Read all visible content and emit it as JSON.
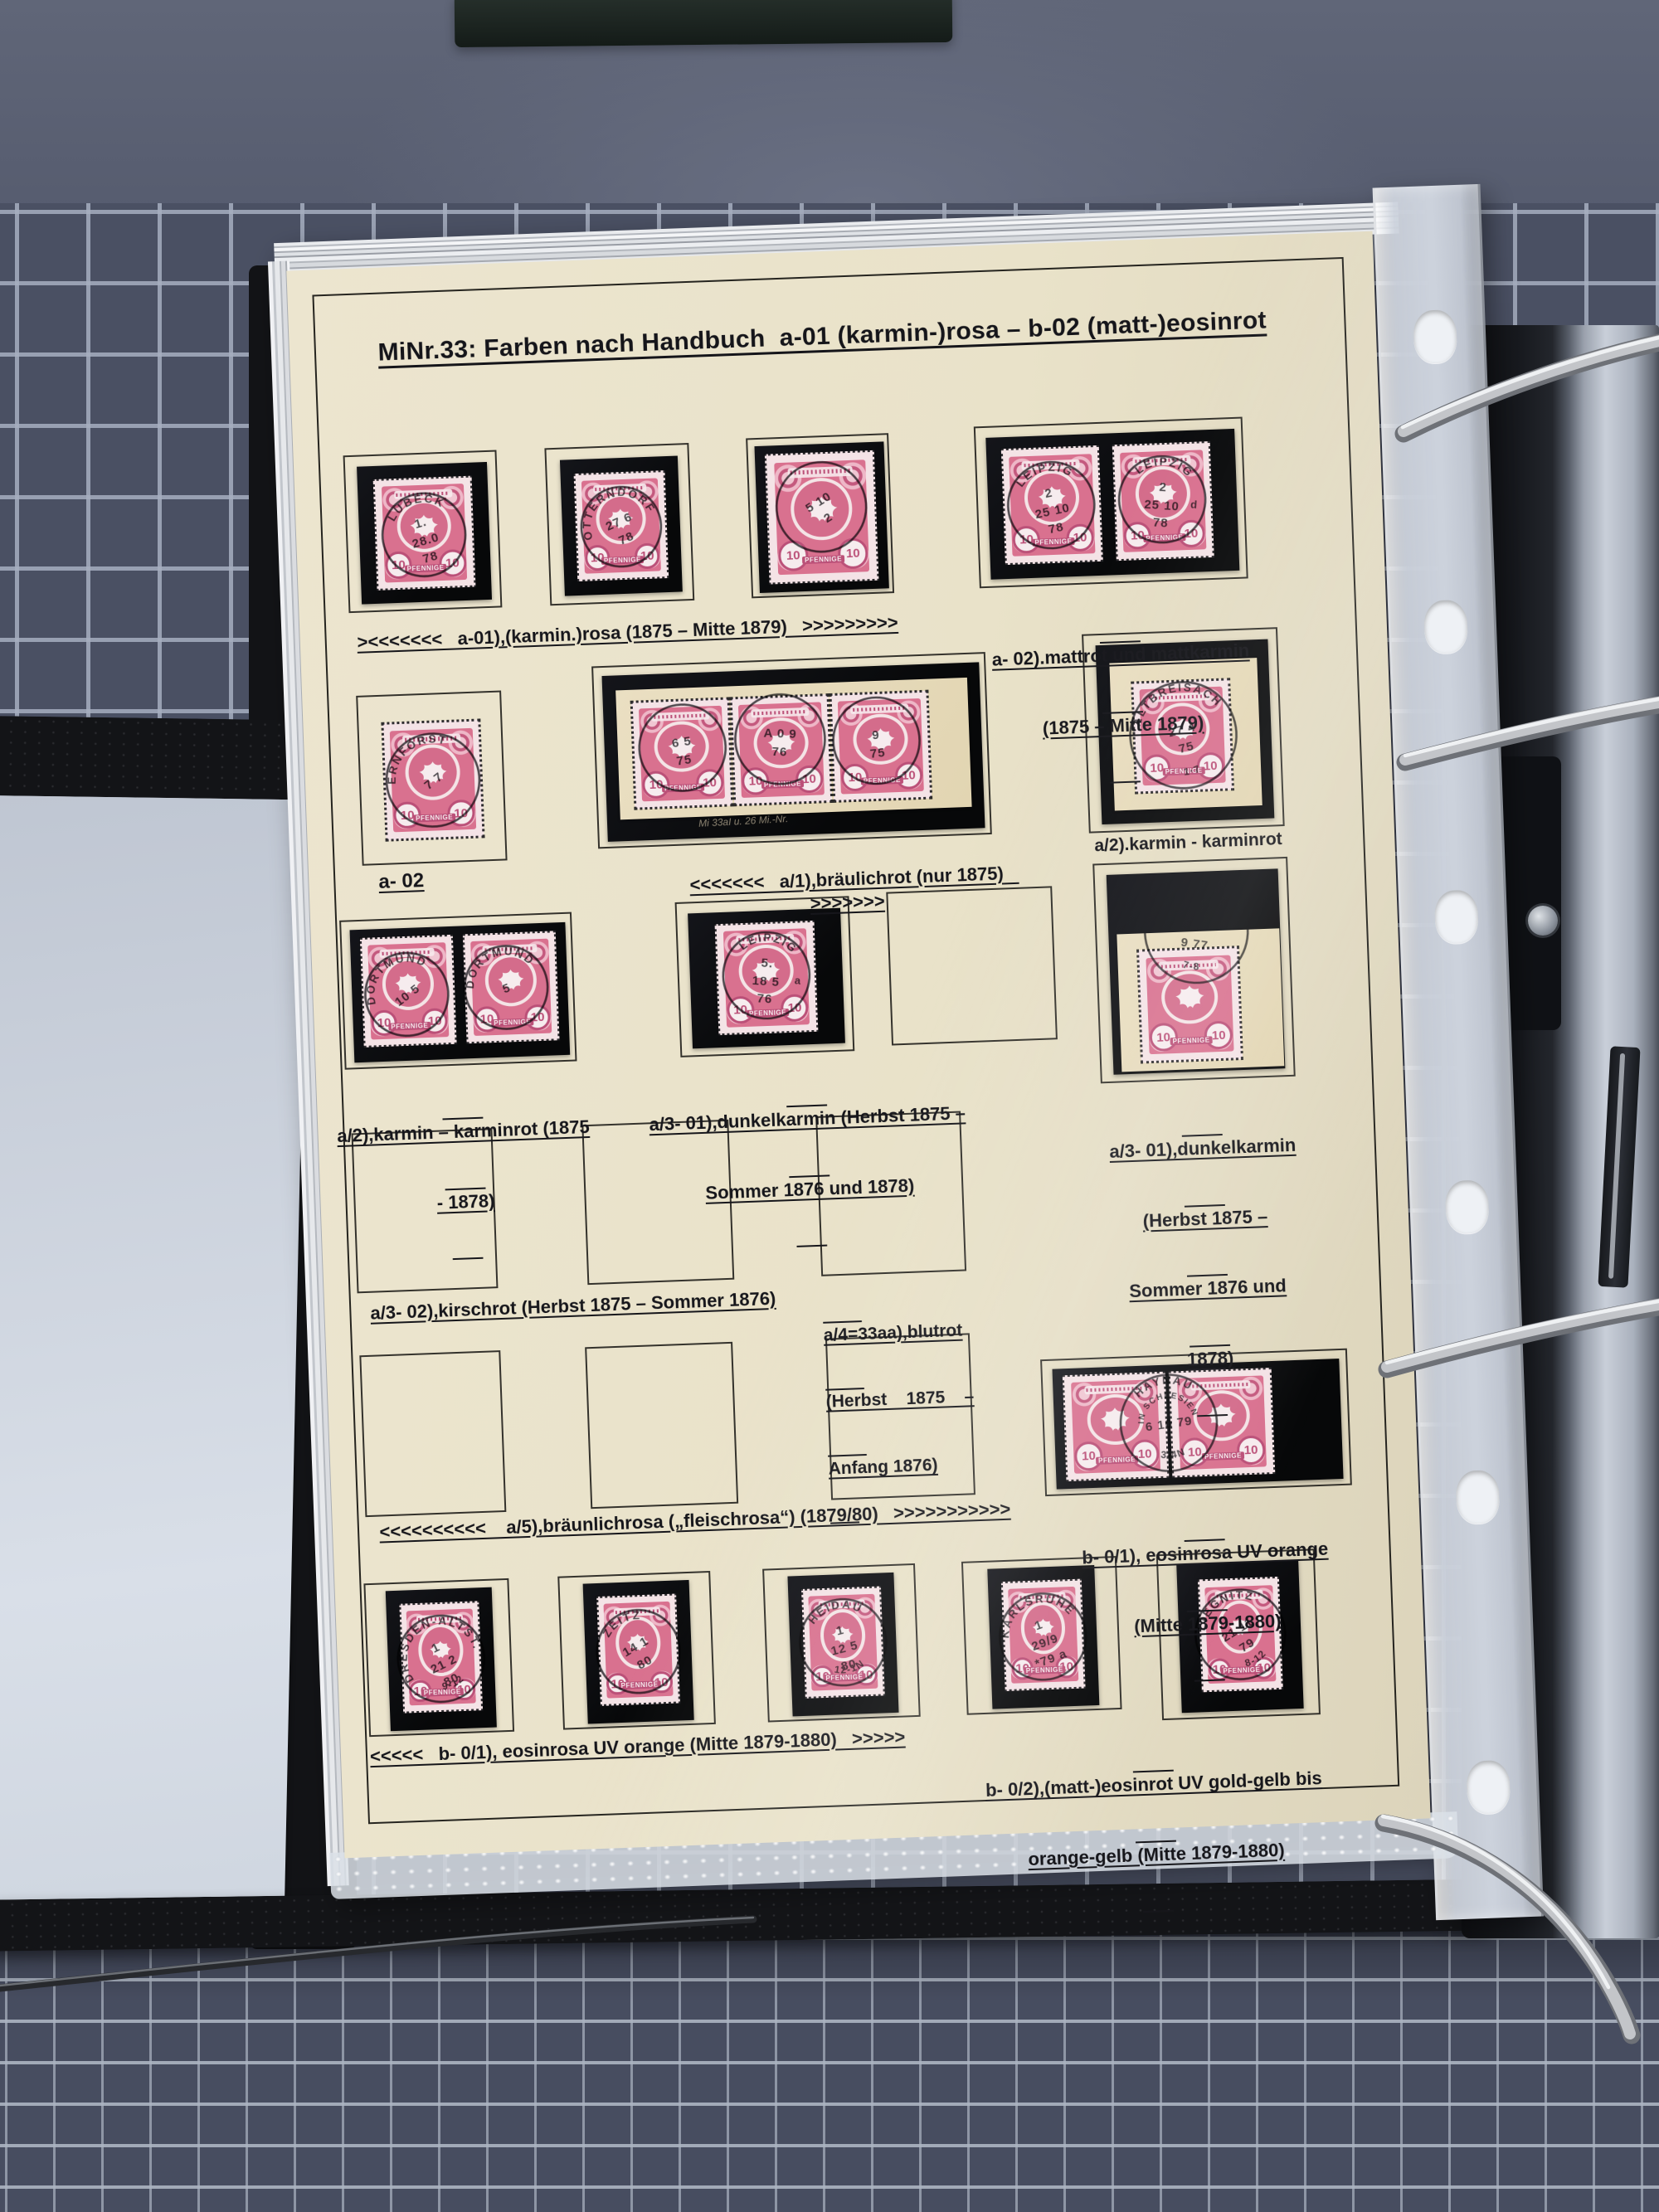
{
  "album": {
    "title": "MiNr.33: Farben nach Handbuch  a-01 (karmin-)rosa – b-02 (matt-)eosinrot",
    "captions": {
      "r1_left": "><<<<<<<   a-01),(karmin.)rosa (1875 – Mitte 1879)   >>>>>>>>>",
      "r1_right_l1": "a- 02).mattrot und mattkarmin",
      "r1_right_l2": "(1875 – Mitte 1879)",
      "r2_a02": "a- 02",
      "r2_strip": "<<<<<<<   a/1),bräulichrot (nur 1875)   >>>>>>>",
      "r2_right": "a/2).karmin - karminrot",
      "r3_pair_l1": "a/2),karmin – karminrot (1875",
      "r3_pair_l2": "- 1878)",
      "r3_mid_l1": "a/3- 01),dunkelkarmin (Herbst 1875 –",
      "r3_mid_l2": "Sommer 1876 und 1878)",
      "r3_right_l1": "a/3- 01),dunkelkarmin",
      "r3_right_l2": "(Herbst 1875 –",
      "r3_right_l3": "Sommer 1876 und",
      "r3_right_l4": "1878)",
      "r4_left": "a/3- 02),kirschrot (Herbst 1875 – Sommer 1876)",
      "r4_right_l1": "a/4=33aa),blutrot",
      "r4_right_l2": "(Herbst    1875    –",
      "r4_right_l3": "Anfang 1876)",
      "r5_left": "<<<<<<<<<<    a/5),bräunlichrosa („fleischrosa“) (1879/80)   >>>>>>>>>>>",
      "r5_right_l1": "b- 0/1), eosinrosa UV orange",
      "r5_right_l2": "(Mitte 1879-1880)",
      "r6_left": "<<<<<   b- 0/1), eosinrosa UV orange (Mitte 1879-1880)   >>>>>",
      "r6_right_l1": "b- 0/2),(matt-)eosinrot UV gold-gelb bis",
      "r6_right_l2": "orange-gelb (Mitte 1879-1880)"
    },
    "stamp_face": {
      "value": "10",
      "inscription": "PFENNIGE"
    },
    "strip_note": "Mi 33aI u. 26 Mi.-Nr.",
    "postmarks": {
      "lubeck": {
        "town": "LÜBECK",
        "lines": [
          "1.",
          "28.0",
          "78"
        ],
        "bottom": ""
      },
      "otterndorf": {
        "town": "OTTERNDORF",
        "lines": [
          "27 6",
          "78"
        ],
        "bottom": ""
      },
      "r1s3": {
        "town": "",
        "lines": [
          "5 10",
          "2"
        ],
        "bottom": ""
      },
      "leipzig1": {
        "town": "LEIPZIG",
        "lines": [
          "2",
          "25 10",
          "78"
        ],
        "bottom": ""
      },
      "leipzig2": {
        "town": "LEIPZIG",
        "lines": [
          "2",
          "25 10",
          "78"
        ],
        "bottom": "",
        "side": "d"
      },
      "ernforst": {
        "town": "ERNFORST",
        "lines": [
          "7 7"
        ],
        "bottom": ""
      },
      "strip1": {
        "town": "",
        "lines": [
          "6 5",
          "75"
        ],
        "bottom": ""
      },
      "strip2": {
        "town": "",
        "lines": [
          "A 0 9",
          "76"
        ],
        "bottom": ""
      },
      "strip3": {
        "town": "",
        "lines": [
          "9",
          "75"
        ],
        "bottom": ""
      },
      "altbreisach": {
        "town": "ALTBREISACH",
        "lines": [
          "27 4",
          "75"
        ],
        "bottom": "1·7"
      },
      "dortmund1": {
        "town": "DORTMUND",
        "lines": [
          "10 5"
        ],
        "bottom": ""
      },
      "dortmund2": {
        "town": "DORTMUND",
        "lines": [
          "5"
        ],
        "bottom": ""
      },
      "leipzigdk": {
        "town": "LEIPZIG",
        "lines": [
          "5.",
          "18 5",
          "76"
        ],
        "bottom": "",
        "side": "a"
      },
      "krotzingen": {
        "town": "KROTZINGEN",
        "lines": [
          "4",
          "9  77"
        ],
        "bottom": "7-8"
      },
      "haynau": {
        "town": "HAYNAU",
        "town2": "IN SCHLESIEN",
        "lines": [
          "6 10 79"
        ],
        "bottom": "3-4N"
      },
      "dresden": {
        "town": "DRESDEN-ALTST.",
        "lines": [
          "1",
          "21 2",
          "80"
        ],
        "bottom": "9-12"
      },
      "zeitz": {
        "town": "ZEITZ",
        "lines": [
          "14 1",
          "80"
        ],
        "bottom": ""
      },
      "heidau": {
        "town": "HEIDAU",
        "lines": [
          "1",
          "12 5",
          "80"
        ],
        "bottom": "12-1N"
      },
      "karlsruhe": {
        "town": "KARLSRUHE",
        "lines": [
          "1",
          "29/9",
          "*79 a"
        ],
        "bottom": ""
      },
      "liegnitz": {
        "town": "LIEGNITZ",
        "lines": [
          "21 11",
          "79"
        ],
        "bottom": "8-12"
      }
    }
  },
  "colors": {
    "page_cream": "#e9e2c9",
    "stamp_pink": "#d9718f",
    "mount_black": "#0b0c0e",
    "mat_blue": "#4a5063",
    "mat_grid": "#a6aebf",
    "postmark_ink": "#1d1d22"
  }
}
